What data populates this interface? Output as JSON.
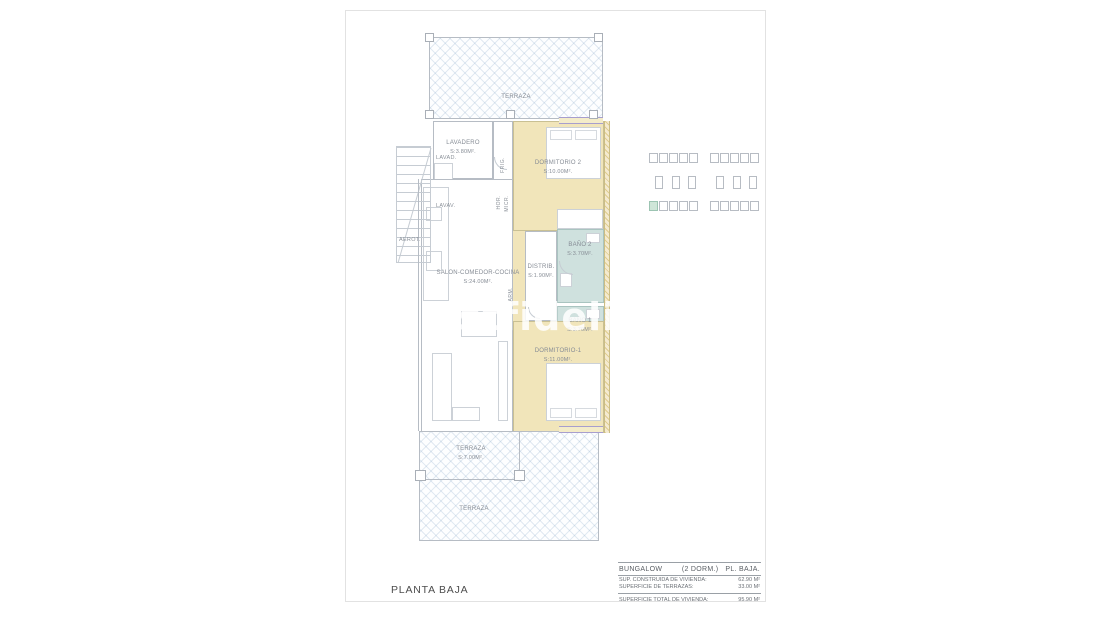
{
  "page": {
    "floor_label": "PLANTA BAJA",
    "watermark": "estfidelit"
  },
  "plan": {
    "rooms": [
      {
        "name": "TERRAZA",
        "area": ""
      },
      {
        "name": "LAVADERO",
        "area": "S:3.80M²."
      },
      {
        "name": "DORMITORIO 2",
        "area": "S:10.00M²."
      },
      {
        "name": "BAÑO 2",
        "area": "S:3.70M²."
      },
      {
        "name": "DISTRIB.",
        "area": "S:1.90M²."
      },
      {
        "name": "SALON-COMEDOR-COCINA",
        "area": "S:24.00M²."
      },
      {
        "name": "BAÑO 1",
        "area": "S:3.70M²."
      },
      {
        "name": "DORMITORIO-1",
        "area": "S:11.00M²."
      },
      {
        "name": "TERRAZA",
        "area": "S:7.00M²."
      },
      {
        "name": "TERRAZA",
        "area": ""
      }
    ],
    "fixtures": {
      "washer": "LAVAD.",
      "sink": "LAVAV.",
      "aero": "AEROT.",
      "fridge": "FRIG.",
      "oven": "HOR.",
      "micro": "MICR.",
      "closet": "ARM."
    }
  },
  "keyplan": {
    "blocks": 2,
    "top_row": 5,
    "bottom_row": 5,
    "cores": 3,
    "highlight": {
      "block": 0,
      "row": "bottom",
      "index": 0
    },
    "highlight_color": "#cfe5d8"
  },
  "summary": {
    "type_label": "BUNGALOW",
    "dorm_label": "(2 DORM.)",
    "floor_label": "PL. BAJA.",
    "rows": [
      {
        "label": "SUP. CONSTRUIDA DE VIVIENDA:",
        "value": "62.90 M²"
      },
      {
        "label": "SUPERFICIE DE TERRAZAS:",
        "value": "33.00 M²"
      }
    ],
    "total_label": "SUPERFICIE TOTAL DE VIVIENDA:",
    "total_value": "95.90 M²"
  },
  "colors": {
    "bedroom": "#f1e5ba",
    "bath": "#cfe1de",
    "hatch_line": "#cfe0ec",
    "window": "#a79ece",
    "highlight": "#cfe5d8"
  }
}
